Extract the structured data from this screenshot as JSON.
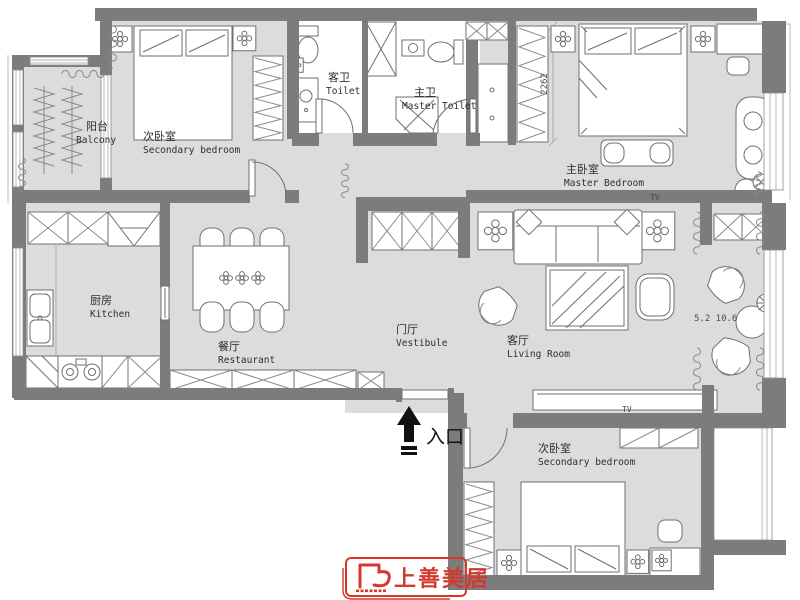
{
  "colors": {
    "wall": "#7c7c7c",
    "floor": "#dcdcdc",
    "line": "#6f6f6f",
    "logo_red": "#d4382d"
  },
  "rooms": {
    "balcony": {
      "zh": "阳台",
      "en": "Balcony"
    },
    "bedroom_top": {
      "zh": "次卧室",
      "en": "Secondary bedroom"
    },
    "guest_toilet": {
      "zh": "客卫",
      "en": "Toilet"
    },
    "master_toilet": {
      "zh": "主卫",
      "en": "Master Toilet"
    },
    "master_bedroom": {
      "zh": "主卧室",
      "en": "Master Bedroom"
    },
    "kitchen": {
      "zh": "厨房",
      "en": "Kitchen"
    },
    "dining": {
      "zh": "餐厅",
      "en": "Restaurant"
    },
    "vestibule": {
      "zh": "门厅",
      "en": "Vestibule"
    },
    "living": {
      "zh": "客厅",
      "en": "Living Room"
    },
    "bedroom_bottom": {
      "zh": "次卧室",
      "en": "Secondary bedroom"
    }
  },
  "annotations": {
    "wardrobe_dimension": "2262",
    "area_note": "5.2 10.6",
    "tv_master": "TV",
    "tv_living": "TV",
    "entrance_label": "入口"
  },
  "logo": {
    "name": "上善美居"
  }
}
